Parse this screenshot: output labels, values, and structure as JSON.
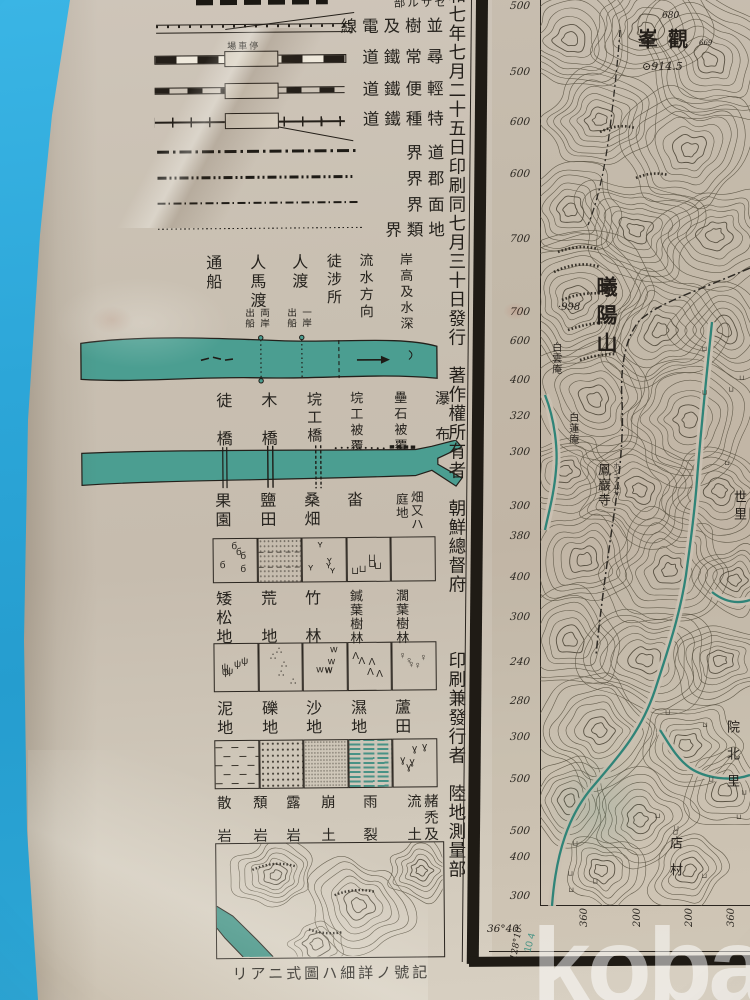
{
  "watermark": {
    "text": "kobay"
  },
  "colors": {
    "backdrop_blue": "#2ca6d8",
    "paper": "#c9c0b2",
    "ink": "#26231e",
    "water_teal": "#4b9e91",
    "stream_teal": "#2f8478",
    "contour": "#57503f"
  },
  "legend": {
    "line_rows": [
      {
        "label": "部ルサセ",
        "sym": "bars",
        "y": -6,
        "small": true
      },
      {
        "label": "線電及樹並",
        "sym": "trees",
        "y": 14
      },
      {
        "label": "道鐵常尋",
        "sym": "rail1",
        "y": 45,
        "station": "場車停",
        "box": true
      },
      {
        "label": "道鐵便輕",
        "sym": "rail2",
        "y": 77,
        "box": true
      },
      {
        "label": "道鐵種特",
        "sym": "rail3",
        "y": 107,
        "box": true
      },
      {
        "label": "界道",
        "sym": "b1",
        "y": 141
      },
      {
        "label": "界郡",
        "sym": "b2",
        "y": 167
      },
      {
        "label": "界面",
        "sym": "b3",
        "y": 193
      },
      {
        "label": "界類地",
        "sym": "b4",
        "y": 218
      }
    ],
    "colophon": "和七年七月二十五日印刷同七月三十日發行　著作權所有者　朝鮮總督府　　　印刷兼發行者　陸地測量部",
    "river_section1": [
      {
        "text": "通船",
        "x": 215,
        "size": 16
      },
      {
        "text": "人馬渡",
        "x": 259,
        "size": 16,
        "sub_right": "両岸",
        "sub_left": "出船"
      },
      {
        "text": "人渡",
        "x": 301,
        "size": 16,
        "sub_right": "一岸",
        "sub_left": "出船"
      },
      {
        "text": "徒涉所",
        "x": 337,
        "size": 15
      },
      {
        "text": "流水方向",
        "x": 370,
        "size": 14
      },
      {
        "text": "岸高及水深",
        "x": 409,
        "size": 13
      }
    ],
    "river_section2": [
      {
        "text": "徒橋",
        "x": 224,
        "size": 16,
        "gap": true
      },
      {
        "text": "木橋",
        "x": 269,
        "size": 16,
        "gap": true
      },
      {
        "text": "垸工橋",
        "x": 316,
        "size": 15
      },
      {
        "text": "垸工被覆",
        "x": 358,
        "size": 13
      },
      {
        "text": "壘石被覆",
        "x": 402,
        "size": 13
      },
      {
        "text": "瀑布",
        "x": 444,
        "size": 15,
        "gap": true
      }
    ],
    "land_rows": [
      {
        "y_label": 492,
        "y_box": 538,
        "box_h": 45,
        "cols": [
          {
            "label": "果園",
            "x": 222,
            "mark": "б"
          },
          {
            "label": "鹽田",
            "x": 267,
            "fill": "salt"
          },
          {
            "label": "桑畑",
            "x": 311,
            "mark": "ʏ"
          },
          {
            "label": "畓",
            "x": 354,
            "mark": "⊔"
          },
          {
            "label": "畑又ハ庭地",
            "x": 415,
            "two_col": [
              "畑又ハ",
              "庭地"
            ]
          }
        ]
      },
      {
        "y_label": 590,
        "y_box": 643,
        "box_h": 49,
        "cols": [
          {
            "label": "矮松地",
            "x": 222,
            "mark": "ψ"
          },
          {
            "label": "荒地",
            "x": 267,
            "mark": "∴",
            "gap": true
          },
          {
            "label": "竹林",
            "x": 311,
            "mark": "w",
            "gap": true
          },
          {
            "label": "鍼葉樹林",
            "x": 356,
            "mark": "Λ",
            "small": true
          },
          {
            "label": "濶葉樹林",
            "x": 402,
            "mark": "♀",
            "small": true
          }
        ]
      },
      {
        "y_label": 700,
        "y_box": 740,
        "box_h": 49,
        "cols": [
          {
            "label": "泥地",
            "x": 222,
            "fill": "mud"
          },
          {
            "label": "礫地",
            "x": 267,
            "fill": "gravel"
          },
          {
            "label": "沙地",
            "x": 311,
            "fill": "sand"
          },
          {
            "label": "濕地",
            "x": 356,
            "fill": "wet"
          },
          {
            "label": "蘆田",
            "x": 400,
            "mark": "ɣ"
          }
        ]
      }
    ],
    "terrain_labels": [
      {
        "text": "散岩",
        "x": 222,
        "gap": true
      },
      {
        "text": "頽岩",
        "x": 258,
        "gap": true
      },
      {
        "text": "露岩",
        "x": 291,
        "gap": true
      },
      {
        "text": "崩土",
        "x": 326,
        "gap": true
      },
      {
        "text": "雨裂",
        "x": 368,
        "gap": true
      },
      {
        "text": "流土",
        "x": 412,
        "gap": true
      },
      {
        "text": "赭禿及",
        "x": 429
      }
    ],
    "footnote": "リアニ式圖ハ細詳ノ號記"
  },
  "map": {
    "edge_elevations": [
      {
        "v": "500",
        "y": 0
      },
      {
        "v": "500",
        "y": 66
      },
      {
        "v": "600",
        "y": 116
      },
      {
        "v": "600",
        "y": 168
      },
      {
        "v": "700",
        "y": 233
      },
      {
        "v": "700",
        "y": 306
      },
      {
        "v": "600",
        "y": 335
      },
      {
        "v": "400",
        "y": 374
      },
      {
        "v": "320",
        "y": 410
      },
      {
        "v": "300",
        "y": 446
      },
      {
        "v": "300",
        "y": 500
      },
      {
        "v": "380",
        "y": 530
      },
      {
        "v": "400",
        "y": 571
      },
      {
        "v": "300",
        "y": 611
      },
      {
        "v": "240",
        "y": 656
      },
      {
        "v": "280",
        "y": 695
      },
      {
        "v": "300",
        "y": 731
      },
      {
        "v": "500",
        "y": 773
      },
      {
        "v": "500",
        "y": 825
      },
      {
        "v": "400",
        "y": 851
      },
      {
        "v": "300",
        "y": 890
      }
    ],
    "bottom_elevations": [
      {
        "v": "360",
        "x": 575
      },
      {
        "v": "200",
        "x": 628
      },
      {
        "v": "200",
        "x": 680
      },
      {
        "v": "360",
        "x": 722
      }
    ],
    "corner_lat": "36°40′",
    "corner_lon": "128°10′",
    "corner_note": "10 4",
    "labels": [
      {
        "text": "680",
        "x": 662,
        "y": 12,
        "size": 9,
        "cls": "num"
      },
      {
        "text": "峯觀",
        "x": 638,
        "y": 30,
        "size": 20,
        "cls": "peak"
      },
      {
        "text": "⊙914.5",
        "x": 642,
        "y": 61,
        "size": 11,
        "cls": "num"
      },
      {
        "text": "669",
        "x": 699,
        "y": 40,
        "size": 7,
        "cls": "num"
      },
      {
        "text": "·998",
        "x": 558,
        "y": 303,
        "size": 10,
        "cls": "num"
      },
      {
        "text": "曦陽山",
        "x": 608,
        "y": 276,
        "size": 21,
        "vertical": true,
        "ls": 7,
        "bold": true
      },
      {
        "text": "白雲庵",
        "x": 556,
        "y": 342,
        "size": 10,
        "vertical": true,
        "ls": 1
      },
      {
        "text": "白蓮庵",
        "x": 573,
        "y": 412,
        "size": 10,
        "vertical": true,
        "ls": 1
      },
      {
        "text": "鳳巖寺",
        "x": 605,
        "y": 463,
        "size": 13,
        "vertical": true,
        "ls": 2
      },
      {
        "text": "ホンアムサ",
        "x": 617,
        "y": 462,
        "size": 7,
        "vertical": true,
        "ls": 0,
        "cls": "kana"
      },
      {
        "text": "世里",
        "x": 741,
        "y": 490,
        "size": 13,
        "vertical": true,
        "ls": 4
      },
      {
        "text": "院北里",
        "x": 734,
        "y": 720,
        "size": 13,
        "vertical": true,
        "ls": 14
      },
      {
        "text": "店村",
        "x": 677,
        "y": 836,
        "size": 13,
        "vertical": true,
        "ls": 14
      }
    ]
  }
}
